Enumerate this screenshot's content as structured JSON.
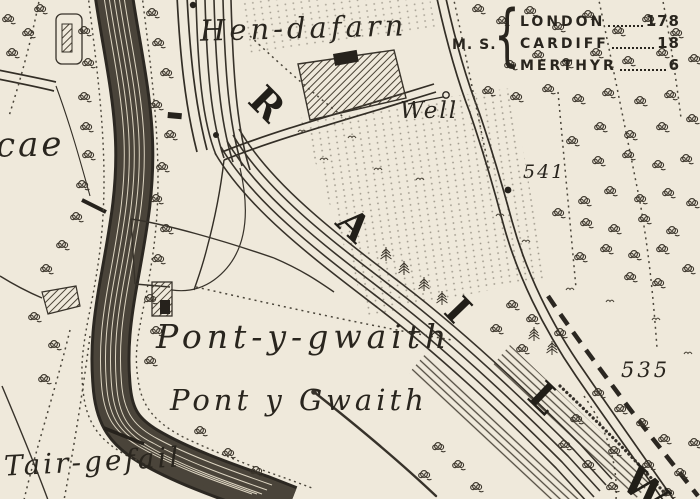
{
  "map": {
    "place_labels": {
      "hen_dafarn": "Hen-dafarn",
      "cae_fragment": "cae",
      "well": "Well",
      "pont_y_gwaith_farm": "Pont-y-gwaith",
      "pont_y_gwaith_hamlet": "Pont y Gwaith",
      "tair_gefail": "Tair-gefail"
    },
    "spot_heights": {
      "h541": "541",
      "h535": "535"
    },
    "railway_letters": {
      "r": "R",
      "a": "A",
      "i": "I",
      "l": "L",
      "w": "W"
    },
    "distance_table": {
      "prefix": "M. S.",
      "brace": "{",
      "rows": [
        {
          "destination": "LONDON",
          "miles": "178"
        },
        {
          "destination": "CARDIFF",
          "miles": "18"
        },
        {
          "destination": "MERTHYR",
          "miles": "6"
        }
      ]
    },
    "colors": {
      "paper": "#efe9db",
      "ink": "#2b2620"
    }
  }
}
